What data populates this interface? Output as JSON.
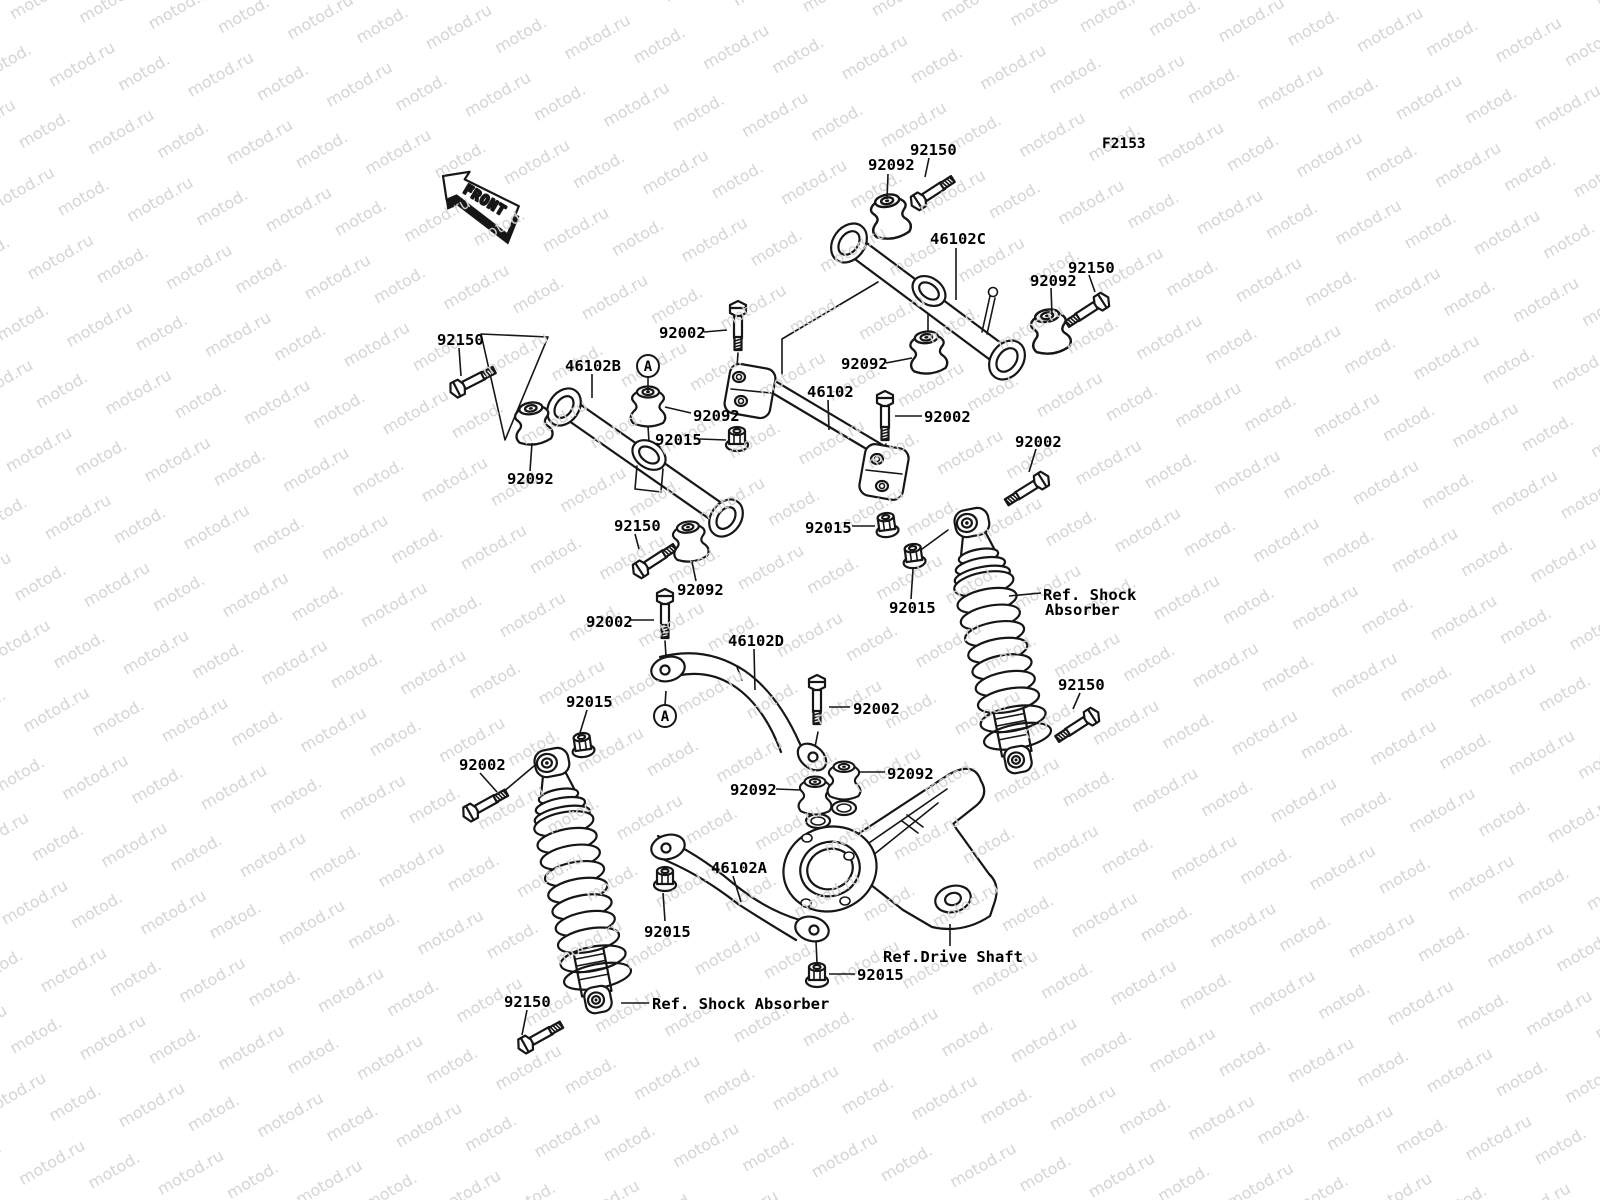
{
  "watermark": {
    "text": "motod.ru",
    "color": "#d4d4d4"
  },
  "figure": {
    "code": "F2153",
    "front_label": "FRONT",
    "marker_letter": "A"
  },
  "colors": {
    "line": "#161616",
    "label": "#000000",
    "background": "#ffffff"
  },
  "part_labels": [
    {
      "text": "92092",
      "x": 868,
      "y": 170,
      "leader": [
        [
          888,
          174
        ],
        [
          887,
          199
        ]
      ]
    },
    {
      "text": "92150",
      "x": 910,
      "y": 155,
      "leader": [
        [
          929,
          158
        ],
        [
          925,
          177
        ]
      ]
    },
    {
      "text": "46102C",
      "x": 930,
      "y": 244,
      "leader": [
        [
          956,
          248
        ],
        [
          956,
          300
        ]
      ]
    },
    {
      "text": "92092",
      "x": 1030,
      "y": 286,
      "leader": [
        [
          1051,
          288
        ],
        [
          1052,
          315
        ]
      ]
    },
    {
      "text": "92150",
      "x": 1068,
      "y": 273,
      "leader": [
        [
          1089,
          275
        ],
        [
          1095,
          292
        ]
      ]
    },
    {
      "text": "92150",
      "x": 437,
      "y": 345,
      "leader": [
        [
          459,
          348
        ],
        [
          461,
          376
        ]
      ]
    },
    {
      "text": "46102B",
      "x": 565,
      "y": 371,
      "leader": [
        [
          592,
          374
        ],
        [
          592,
          398
        ]
      ]
    },
    {
      "text": "92002",
      "x": 659,
      "y": 338,
      "leader": [
        [
          704,
          332
        ],
        [
          727,
          330
        ]
      ]
    },
    {
      "text": "92092",
      "x": 841,
      "y": 369,
      "leader": [
        [
          886,
          363
        ],
        [
          912,
          358
        ]
      ]
    },
    {
      "text": "46102",
      "x": 807,
      "y": 397,
      "leader": [
        [
          828,
          400
        ],
        [
          829,
          430
        ]
      ]
    },
    {
      "text": "92002",
      "x": 924,
      "y": 422,
      "leader": [
        [
          922,
          416
        ],
        [
          895,
          416
        ]
      ]
    },
    {
      "text": "92092",
      "x": 507,
      "y": 484,
      "leader": [
        [
          530,
          471
        ],
        [
          532,
          443
        ]
      ]
    },
    {
      "text": "92092",
      "x": 693,
      "y": 421,
      "leader": [
        [
          691,
          413
        ],
        [
          665,
          407
        ]
      ]
    },
    {
      "text": "92015",
      "x": 655,
      "y": 445,
      "leader": [
        [
          700,
          439
        ],
        [
          726,
          440
        ]
      ]
    },
    {
      "text": "92002",
      "x": 1015,
      "y": 447,
      "leader": [
        [
          1036,
          449
        ],
        [
          1029,
          472
        ]
      ]
    },
    {
      "text": "92015",
      "x": 805,
      "y": 533,
      "leader": [
        [
          852,
          526
        ],
        [
          875,
          526
        ]
      ]
    },
    {
      "text": "92015",
      "x": 889,
      "y": 613,
      "leader": [
        [
          911,
          599
        ],
        [
          913,
          569
        ]
      ]
    },
    {
      "text": "92150",
      "x": 614,
      "y": 531,
      "leader": [
        [
          635,
          534
        ],
        [
          639,
          549
        ]
      ]
    },
    {
      "text": "92092",
      "x": 677,
      "y": 595,
      "leader": [
        [
          696,
          581
        ],
        [
          692,
          562
        ]
      ]
    },
    {
      "text": "92002",
      "x": 586,
      "y": 627,
      "leader": [
        [
          631,
          620
        ],
        [
          654,
          620
        ]
      ]
    },
    {
      "text": "46102D",
      "x": 728,
      "y": 646,
      "leader": [
        [
          754,
          649
        ],
        [
          755,
          690
        ]
      ]
    },
    {
      "text": "92150",
      "x": 1058,
      "y": 690,
      "leader": [
        [
          1080,
          693
        ],
        [
          1073,
          709
        ]
      ]
    },
    {
      "text": "92015",
      "x": 566,
      "y": 707,
      "leader": [
        [
          587,
          710
        ],
        [
          579,
          736
        ]
      ]
    },
    {
      "text": "92002",
      "x": 853,
      "y": 714,
      "leader": [
        [
          850,
          707
        ],
        [
          829,
          707
        ]
      ]
    },
    {
      "text": "92092",
      "x": 730,
      "y": 795,
      "leader": [
        [
          776,
          789
        ],
        [
          801,
          790
        ]
      ]
    },
    {
      "text": "92092",
      "x": 887,
      "y": 779,
      "leader": [
        [
          885,
          772
        ],
        [
          859,
          772
        ]
      ]
    },
    {
      "text": "92002",
      "x": 459,
      "y": 770,
      "leader": [
        [
          480,
          773
        ],
        [
          497,
          792
        ]
      ]
    },
    {
      "text": "46102A",
      "x": 711,
      "y": 873,
      "leader": [
        [
          733,
          876
        ],
        [
          741,
          902
        ]
      ]
    },
    {
      "text": "92015",
      "x": 644,
      "y": 937,
      "leader": [
        [
          665,
          921
        ],
        [
          663,
          893
        ]
      ]
    },
    {
      "text": "92015",
      "x": 857,
      "y": 980,
      "leader": [
        [
          855,
          974
        ],
        [
          829,
          974
        ]
      ]
    },
    {
      "text": "92150",
      "x": 504,
      "y": 1007,
      "leader": [
        [
          527,
          1010
        ],
        [
          522,
          1035
        ]
      ]
    },
    {
      "text": "Ref. Shock",
      "x": 1043,
      "y": 600,
      "leader": [
        [
          1041,
          593
        ],
        [
          1009,
          596
        ]
      ]
    },
    {
      "text": "Absorber",
      "x": 1045,
      "y": 615,
      "leader": []
    },
    {
      "text": "Ref.Drive Shaft",
      "x": 883,
      "y": 962,
      "leader": [
        [
          950,
          946
        ],
        [
          950,
          924
        ]
      ]
    },
    {
      "text": "Ref. Shock Absorber",
      "x": 652,
      "y": 1009,
      "leader": [
        [
          649,
          1003
        ],
        [
          621,
          1003
        ]
      ]
    }
  ],
  "markers": [
    {
      "label": "A",
      "x": 648,
      "y": 366,
      "line": [
        [
          648,
          377
        ],
        [
          648,
          391
        ]
      ]
    },
    {
      "label": "A",
      "x": 665,
      "y": 716,
      "line": [
        [
          665,
          705
        ],
        [
          666,
          691
        ]
      ]
    }
  ]
}
